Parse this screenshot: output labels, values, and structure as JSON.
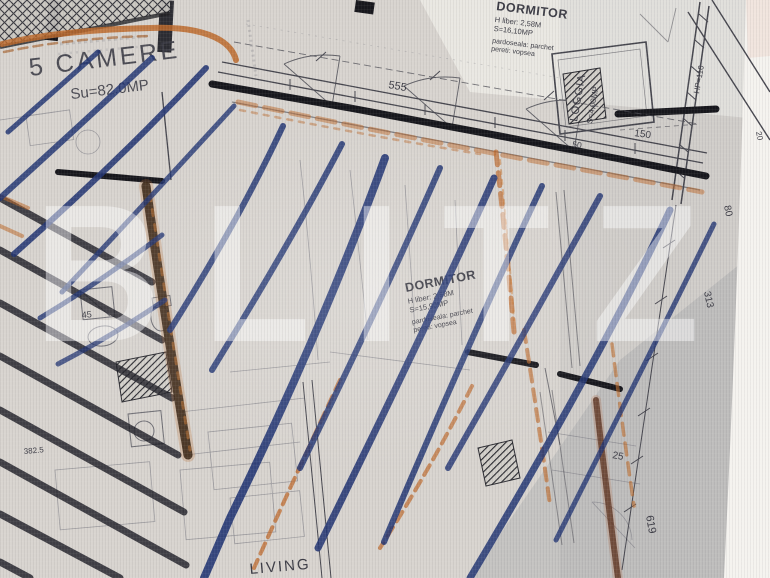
{
  "watermark": {
    "text": "BLITZ"
  },
  "unit_label": {
    "title": "5 CAMERE",
    "area": "Su=82.0MP"
  },
  "rooms": {
    "dormitor_top": {
      "name": "DORMITOR",
      "height": "H liber: 2,58M",
      "area": "S=16,10MP",
      "floor": "pardoseala: parchet",
      "walls": "pereti: vopsea"
    },
    "dormitor_mid": {
      "name": "DORMITOR",
      "height": "H liber: 2,58M",
      "area": "S=15,90MP",
      "floor": "pardoseala: parchet",
      "walls": "pereti: vopsea"
    },
    "loggia": {
      "name": "LOGGIA",
      "area": "S=4,00MP",
      "parapet": "HP=110"
    },
    "living": {
      "name": "LIVING"
    }
  },
  "dimensions": {
    "top_span": "555",
    "loggia_width": "150",
    "loggia_offset": "50",
    "right_1": "80",
    "right_2": "313",
    "right_3": "25",
    "right_4": "619",
    "bath_width": "45",
    "left_height": "382.5",
    "edge_small": "20"
  },
  "colors": {
    "blue_marker": "#233673",
    "orange_marker": "#bd6a2c",
    "paper": "#d8d4cf",
    "ink": "#3a3a42"
  }
}
